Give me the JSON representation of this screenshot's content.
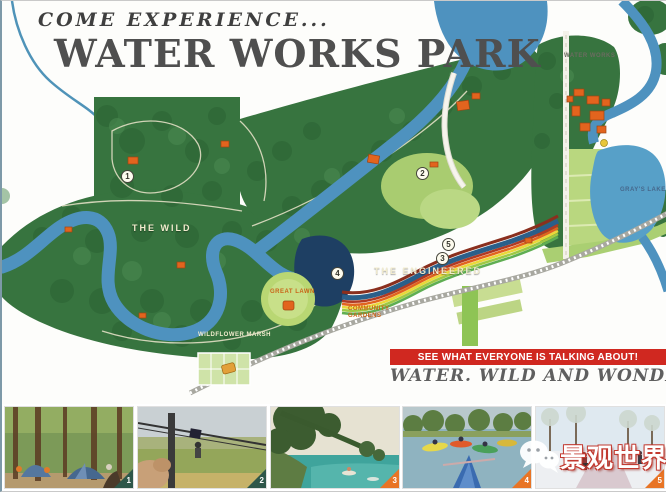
{
  "header": {
    "kicker": "COME EXPERIENCE...",
    "title": "WATER WORKS PARK"
  },
  "banner": {
    "line1": "SEE WHAT EVERYONE IS TALKING ABOUT!",
    "line2": "WATER. WILD AND WONDER!"
  },
  "map": {
    "area_labels": [
      {
        "text": "THE WILD"
      },
      {
        "text": "THE ENGINEERED"
      },
      {
        "text": "WATER WORKS"
      },
      {
        "text": "GRAY'S LAKE"
      },
      {
        "text": "COMMUNITY GARDENS"
      },
      {
        "text": "GREAT LAWN"
      },
      {
        "text": "WILDFLOWER MARSH"
      }
    ],
    "markers": [
      {
        "number": "1"
      },
      {
        "number": "2"
      },
      {
        "number": "3"
      },
      {
        "number": "4"
      },
      {
        "number": "5"
      }
    ]
  },
  "photos": [
    {
      "badge": "1",
      "subject": "forest-camping-tents"
    },
    {
      "badge": "2",
      "subject": "zipline-over-meadow"
    },
    {
      "badge": "3",
      "subject": "creek-swimming-hole"
    },
    {
      "badge": "4",
      "subject": "kayak-launch"
    },
    {
      "badge": "5",
      "subject": "winter-trail-walk"
    }
  ],
  "watermark": {
    "text": "景观世界"
  },
  "colors": {
    "accent_red": "#d02820",
    "forest_green": "#37743f",
    "river_blue": "#4e92bf",
    "badge_green": "#2e574a",
    "badge_orange": "#e87425"
  }
}
